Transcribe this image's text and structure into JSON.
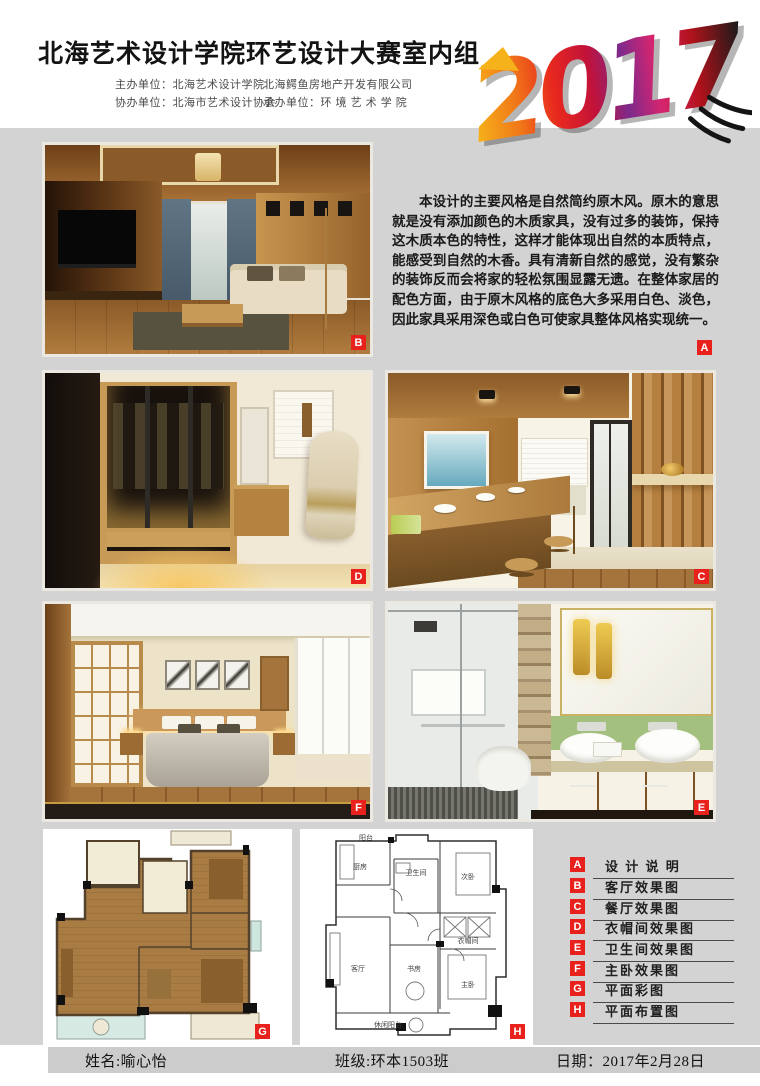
{
  "header": {
    "title": "北海艺术设计学院环艺设计大赛室内组",
    "year": "2017",
    "org_rows": [
      {
        "c1": "主办单位：北海艺术设计学院",
        "c2": "北海鳄鱼房地产开发有限公司"
      },
      {
        "c1": "协办单位：北海市艺术设计协会",
        "c2": "承办单位：环 境 艺 术 学 院"
      }
    ]
  },
  "description": {
    "text": "本设计的主要风格是自然简约原木风。原木的意思就是没有添加颜色的木质家具，没有过多的装饰，保持这木质本色的特性，这样才能体现出自然的本质特点，能感受到自然的木香。具有清新自然的感觉，没有繁杂的装饰反而会将家的轻松氛围显露无遗。在整体家居的配色方面，由于原木风格的底色大多采用白色、淡色，因此家具采用深色或白色可使家具整体风格实现统一。"
  },
  "badges": {
    "a": "A",
    "b": "B",
    "c": "C",
    "d": "D",
    "e": "E",
    "f": "F",
    "g": "G",
    "h": "H"
  },
  "legend": {
    "items": [
      {
        "badge": "A",
        "label": "设 计 说 明"
      },
      {
        "badge": "B",
        "label": "客厅效果图"
      },
      {
        "badge": "C",
        "label": "餐厅效果图"
      },
      {
        "badge": "D",
        "label": "衣帽间效果图"
      },
      {
        "badge": "E",
        "label": "卫生间效果图"
      },
      {
        "badge": "F",
        "label": "主卧效果图"
      },
      {
        "badge": "G",
        "label": "平面彩图"
      },
      {
        "badge": "H",
        "label": "平面布置图"
      }
    ]
  },
  "plan_h": {
    "labels": [
      "阳台",
      "厨房",
      "卫生间",
      "次卧",
      "衣帽间",
      "主卧",
      "客厅",
      "书房",
      "休闲阳台"
    ]
  },
  "footer": {
    "name": "姓名:喻心怡",
    "class": "班级:环本1503班",
    "date": "日期：2017年2月28日"
  },
  "colors": {
    "badge_red": "#e8211c",
    "canvas_grey": "#d3d3d3"
  }
}
